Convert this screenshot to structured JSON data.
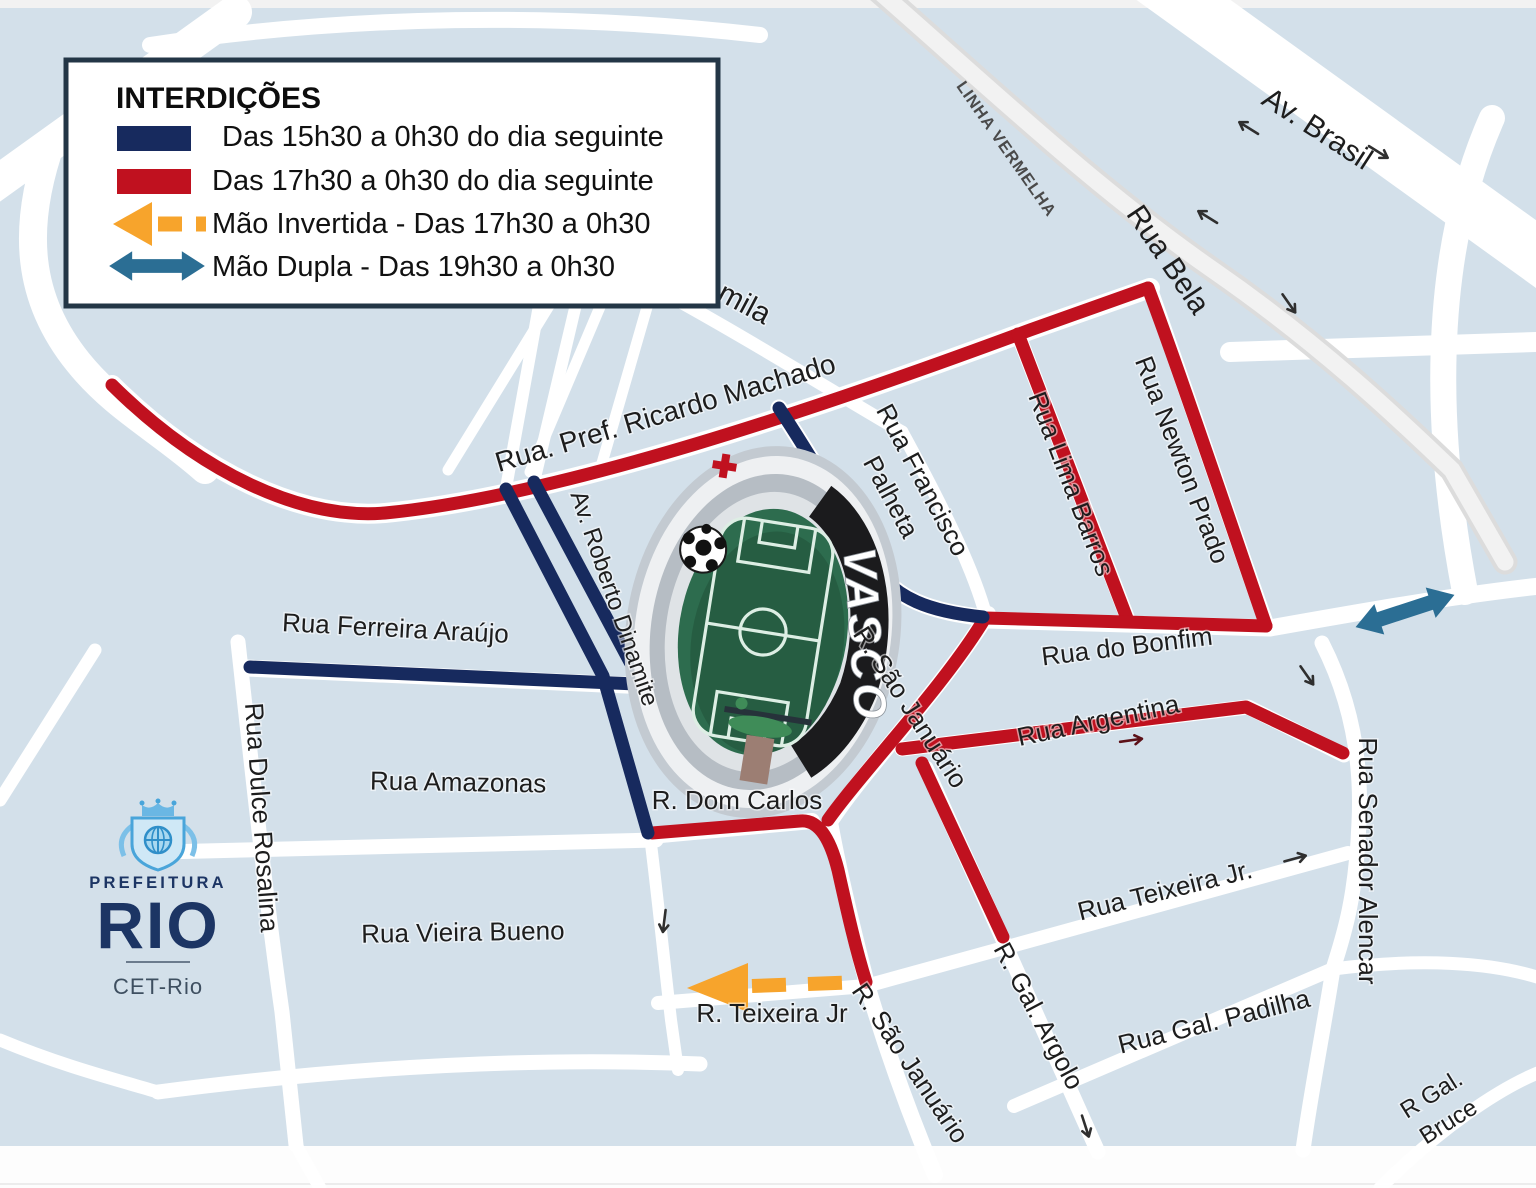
{
  "legend": {
    "title": "INTERDIÇÕES",
    "items": [
      {
        "swatch": "navy-bar",
        "label": "Das 15h30 a 0h30 do dia seguinte"
      },
      {
        "swatch": "red-bar",
        "label": "Das 17h30 a 0h30 do dia seguinte"
      },
      {
        "swatch": "orange-dashed-arrow",
        "label": "Mão Invertida  -  Das 17h30 a 0h30"
      },
      {
        "swatch": "teal-double-arrow",
        "label": "Mão Dupla  - Das 19h30 a 0h30"
      }
    ]
  },
  "map": {
    "labels": {
      "mila": {
        "text": "mila"
      },
      "linha_vermelha": {
        "text": "LINHA VERMELHA"
      },
      "av_brasil": {
        "text": "Av. Brasil"
      },
      "rua_bela": {
        "text": "Rua Bela"
      },
      "ricardo_machado": {
        "text": "Rua. Pref. Ricardo Machado"
      },
      "francisco_l1": {
        "text": "Rua Francisco"
      },
      "francisco_l2": {
        "text": "Palheta"
      },
      "lima_barros": {
        "text": "Rua Lima Barros"
      },
      "newton_prado": {
        "text": "Rua Newton Prado"
      },
      "bonfim": {
        "text": "Rua do Bonfim"
      },
      "dinamite": {
        "text": "Av. Roberto Dinamite"
      },
      "ferreira": {
        "text": "Rua Ferreira Araújo"
      },
      "dulce": {
        "text": "Rua Dulce Rosalina"
      },
      "amazonas": {
        "text": "Rua Amazonas"
      },
      "vieira": {
        "text": "Rua Vieira Bueno"
      },
      "dom_carlos": {
        "text": "R. Dom Carlos"
      },
      "sao_jan_upper": {
        "text": "R. São Januário"
      },
      "sao_jan_lower": {
        "text": "R. São Januário"
      },
      "teixeira_small": {
        "text": "R.  Teixeira Jr"
      },
      "argentina": {
        "text": "Rua Argentina"
      },
      "teixeira_big": {
        "text": "Rua Teixeira Jr."
      },
      "argolo": {
        "text": "R. Gal. Argolo"
      },
      "padilha": {
        "text": "Rua Gal. Padilha"
      },
      "senador": {
        "text": "Rua Senador Alencar"
      },
      "bruce_l1": {
        "text": "R Gal."
      },
      "bruce_l2": {
        "text": "Bruce"
      }
    }
  },
  "stadium": {
    "banner_text": "VASCO"
  },
  "logo": {
    "line1": "PREFEITURA",
    "line2": "RIO",
    "line3": "CET-Rio"
  },
  "colors": {
    "map_background": "#d3e0ea",
    "closure_navy": "#172a5e",
    "closure_red": "#c0111f",
    "inverted_lane_orange": "#f7a42c",
    "two_way_teal": "#2b6e94",
    "logo_navy": "#1c3564"
  }
}
